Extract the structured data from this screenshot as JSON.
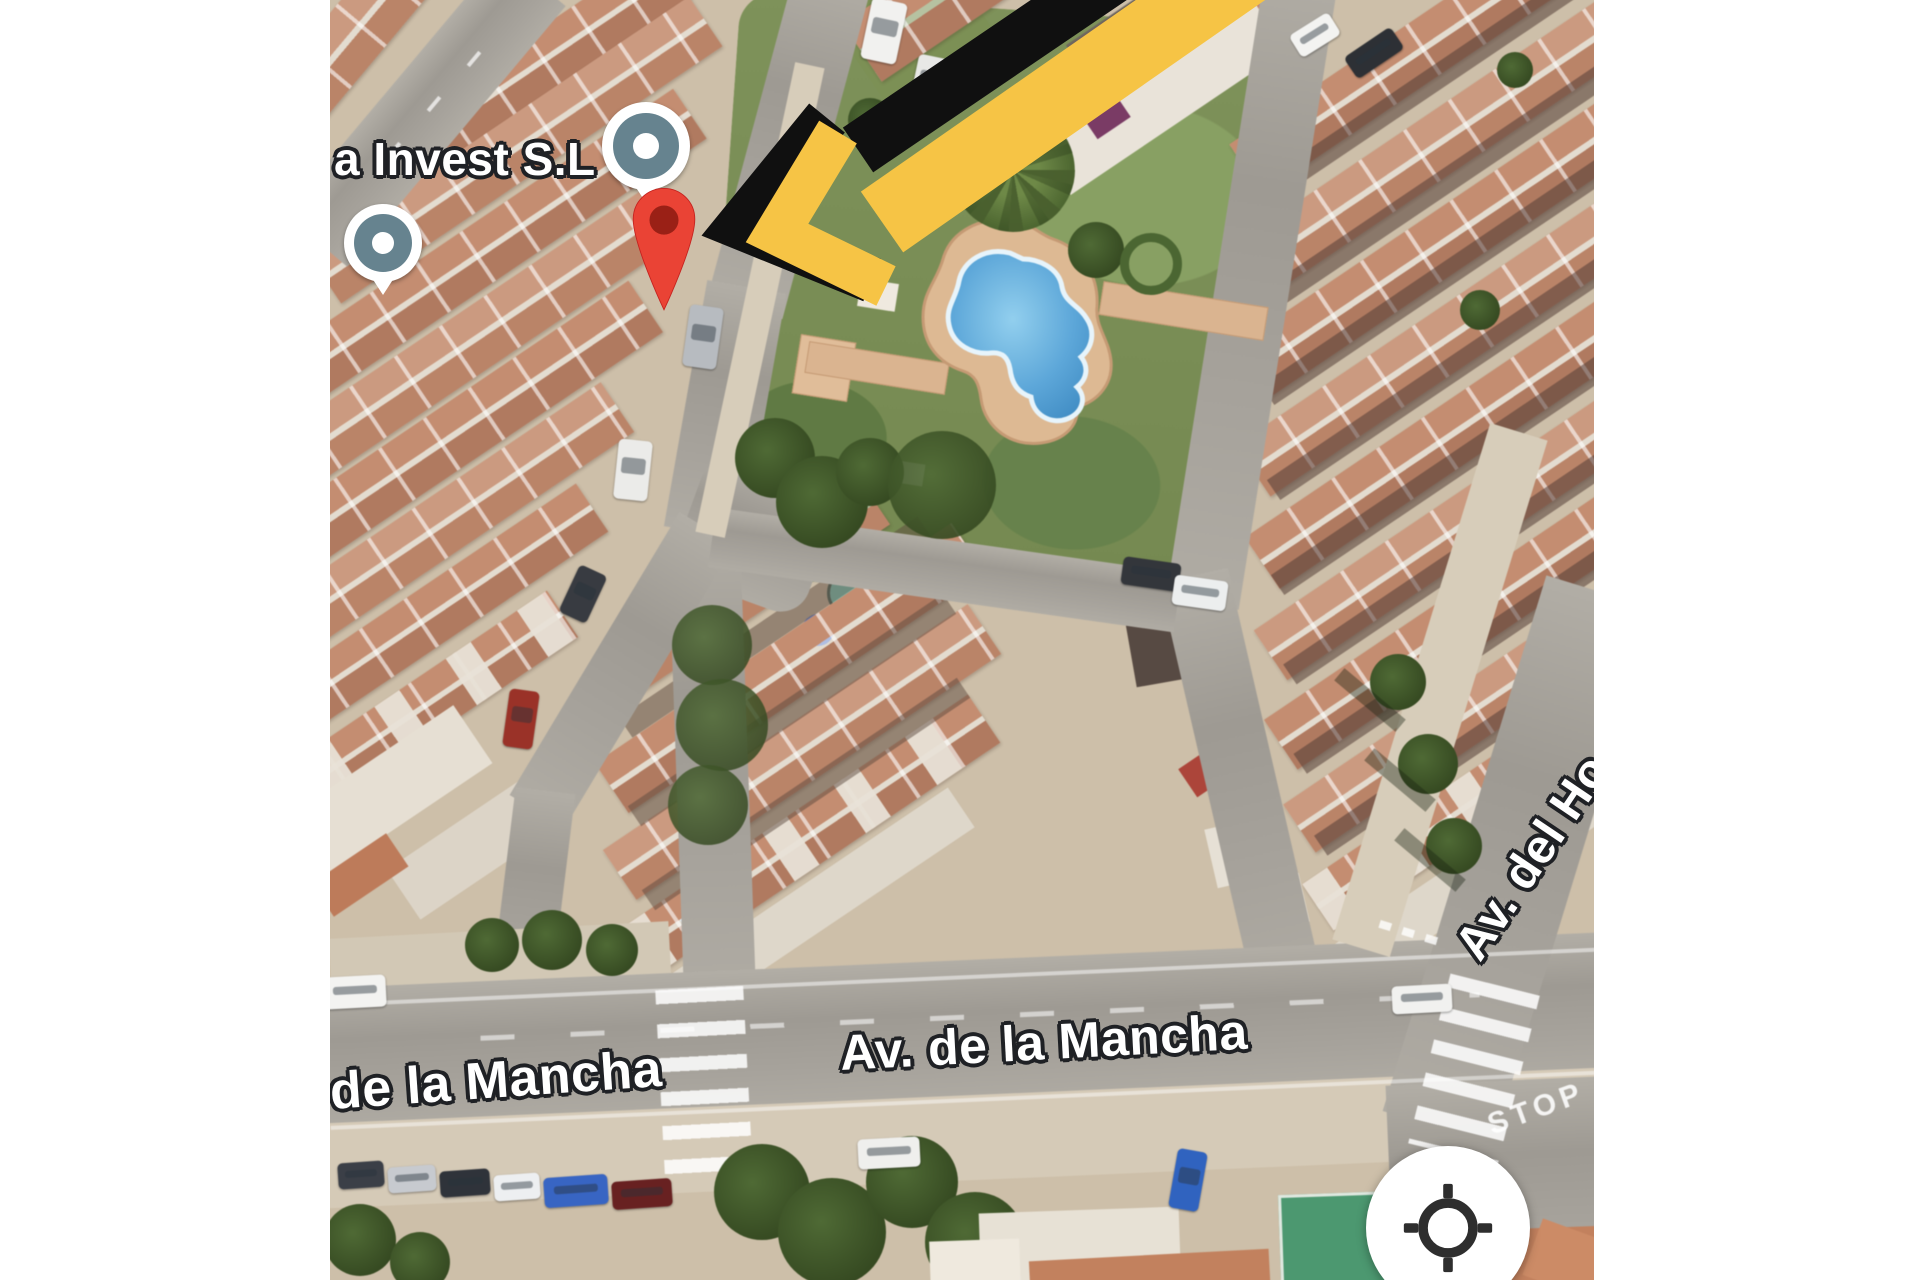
{
  "window": {
    "width": 1920,
    "height": 1280,
    "margin_color": "#FFFFFF"
  },
  "map": {
    "type": "satellite",
    "poi": {
      "name": "a Invest S.L"
    },
    "streets": {
      "left_label": "de la Mancha",
      "center_label": "Av. de la Mancha",
      "right_label": "Av. del Ho"
    },
    "road_markings": {
      "stop": "STOP"
    },
    "annotations": {
      "destination_pin": "red map pin",
      "arrow_colors": [
        "#101010",
        "#F6C445"
      ]
    },
    "controls": {
      "my_location_button": "crosshair"
    },
    "colors": {
      "pin_red": "#EA4335",
      "pin_inner": "#8C1A10",
      "poi_marker": "#66838F",
      "arrow_yellow": "#F6C445",
      "arrow_black": "#101010",
      "pool_water": "#4FA0D8",
      "pool_deck": "#DFB991",
      "grass": "#7D9257",
      "roof_terracotta": "#C68D6F",
      "road_gray": "#A7A39C"
    }
  }
}
